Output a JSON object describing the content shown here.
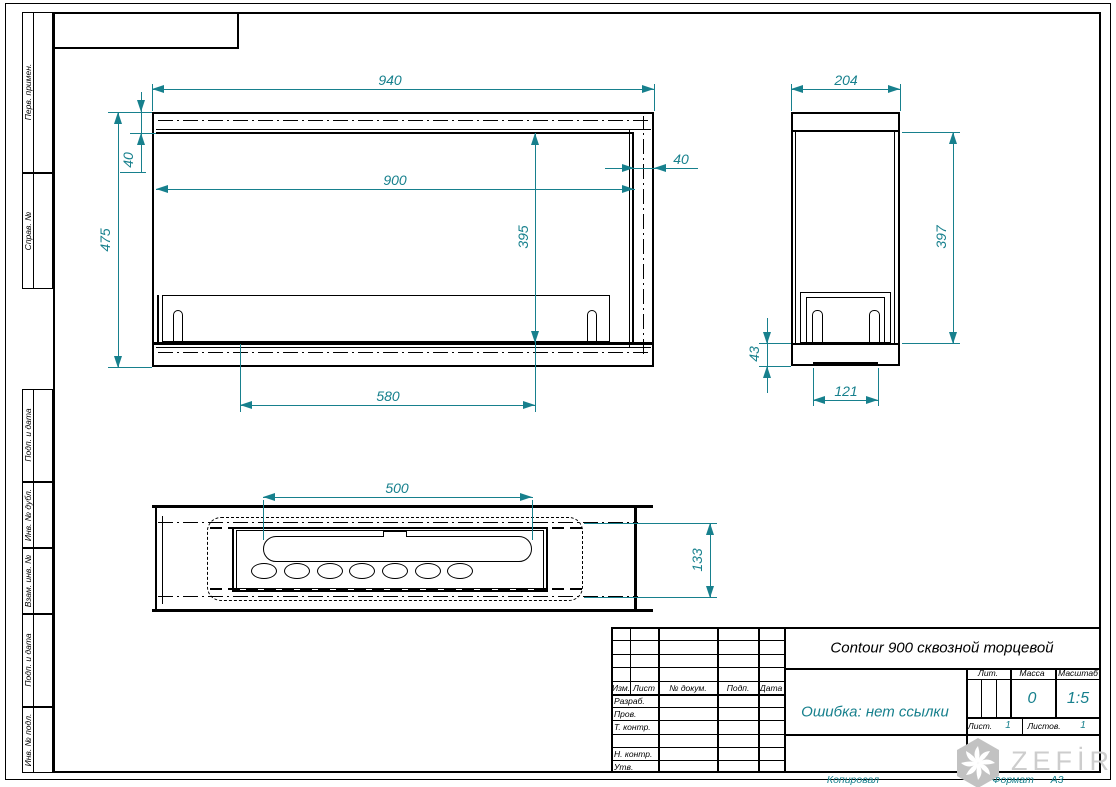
{
  "sheet": {
    "title": "Contour 900 сквозной торцевой",
    "doc_name_note": "Ошибка: нет ссылки",
    "mass_value": "0",
    "scale_value": "1:5",
    "sheet_value": "1",
    "sheets_total_value": "1",
    "copied_label": "Копировал",
    "format_label": "Формат",
    "format_value": "А3"
  },
  "title_block_labels": {
    "izm": "Изм.",
    "list": "Лист",
    "ndoc": "№ докум.",
    "podp": "Подп.",
    "data": "Дата",
    "razrab": "Разраб.",
    "prov": "Пров.",
    "tkontr": "Т. контр.",
    "nkontr": "Н. контр.",
    "utv": "Утв.",
    "lit": "Лит.",
    "massa": "Масса",
    "masshtab": "Масштаб",
    "list2": "Лист.",
    "listov": "Листов."
  },
  "margin_labels": {
    "perv": "Перв. примен.",
    "sprav": "Справ. №",
    "podp1": "Подп. и дата",
    "dubl": "Инв. № дубл.",
    "vzam": "Взам. инв. №",
    "podp2": "Подп. и дата",
    "podl": "Инв. № подл."
  },
  "dims": {
    "fv_width": "940",
    "fv_height": "475",
    "fv_opening_w": "900",
    "fv_opening_h": "395",
    "fv_top_band": "40",
    "fv_right_band": "40",
    "fv_burner": "580",
    "sv_depth": "204",
    "sv_height": "397",
    "sv_base_h": "43",
    "sv_base_w": "121",
    "pv_slot": "500",
    "pv_depth": "133"
  },
  "logo": {
    "text": "ZEFİRE"
  },
  "colors": {
    "dimension": "#17808d",
    "line": "#000000",
    "logo_gray": "#c6c6c6"
  }
}
